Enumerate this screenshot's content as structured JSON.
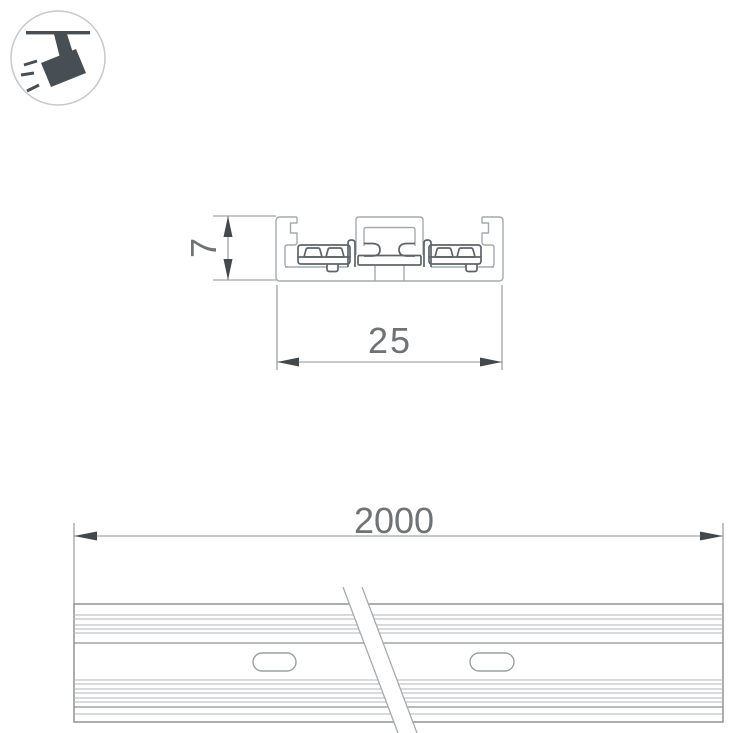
{
  "icon": {
    "name": "track-spotlight",
    "circle_color": "#c5c9cc",
    "glyph_color": "#474f54"
  },
  "cross_section_view": {
    "height_dim": "7",
    "width_dim": "25"
  },
  "length_view": {
    "length_dim": "2000"
  },
  "style": {
    "aluminum_line_color": "#a4aaae",
    "insert_line_color": "#5d646a",
    "thin_rib_line_color": "#b2b6b9",
    "frame_line_color": "#8d9297",
    "dim_line_color": "#8d9196",
    "arrow_color": "#43484d",
    "dimension_text_color": "#6f7376",
    "background": "#ffffff"
  }
}
